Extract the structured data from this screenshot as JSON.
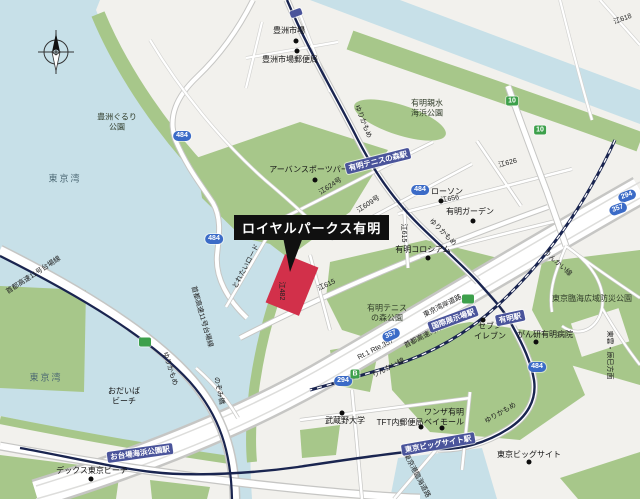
{
  "callout": {
    "text": "ロイヤルパークス有明"
  },
  "map": {
    "compass_icon": "north-compass",
    "colors": {
      "water": "#c7e0e8",
      "land": "#f2f1ed",
      "park": "#a7c78a",
      "rail": "#1a2550",
      "station_bg": "#4a549b",
      "shield_blue": "#3b6bc7",
      "shield_green": "#3da04b",
      "highlight_red": "#d2304a",
      "callout_bg": "#101010"
    },
    "water_labels": [
      {
        "text": "東京湾",
        "x": 65,
        "y": 179
      },
      {
        "text": "東京湾",
        "x": 46,
        "y": 378
      }
    ],
    "park_labels": [
      {
        "text": "豊洲ぐるり\n公園",
        "x": 117,
        "y": 122
      },
      {
        "text": "有明親水\n海浜公園",
        "x": 427,
        "y": 108
      },
      {
        "text": "有明テニス\nの森公園",
        "x": 387,
        "y": 313
      },
      {
        "text": "東京臨海広域防災公園",
        "x": 592,
        "y": 299
      }
    ],
    "pois": [
      {
        "text": "豊洲市場",
        "x": 289,
        "y": 31,
        "dot": [
          296,
          41
        ]
      },
      {
        "text": "豊洲市場郵便局",
        "x": 290,
        "y": 60,
        "dot": [
          297,
          51
        ]
      },
      {
        "text": "アーバンスポーツパーク",
        "x": 313,
        "y": 170,
        "dot": [
          315,
          180
        ]
      },
      {
        "text": "ローソン",
        "x": 447,
        "y": 192,
        "dot": [
          441,
          201
        ]
      },
      {
        "text": "有明ガーデン",
        "x": 470,
        "y": 212,
        "dot": [
          473,
          221
        ]
      },
      {
        "text": "有明コロシアム",
        "x": 423,
        "y": 250,
        "dot": [
          428,
          258
        ]
      },
      {
        "text": "セブン\nイレブン",
        "x": 490,
        "y": 331,
        "dot": [
          483,
          320
        ]
      },
      {
        "text": "がん研有明病院",
        "x": 545,
        "y": 335,
        "dot": [
          536,
          342
        ]
      },
      {
        "text": "武蔵野大学",
        "x": 345,
        "y": 421,
        "dot": [
          342,
          413
        ]
      },
      {
        "text": "TFT内郵便局",
        "x": 400,
        "y": 423,
        "dot": [
          421,
          427
        ]
      },
      {
        "text": "ワンザ有明\nベイモール",
        "x": 444,
        "y": 417,
        "dot": [
          442,
          428
        ]
      },
      {
        "text": "東京ビッグサイト",
        "x": 529,
        "y": 455,
        "dot": [
          529,
          462
        ]
      },
      {
        "text": "デックス東京ビーチ",
        "x": 92,
        "y": 471,
        "dot": [
          91,
          479
        ]
      },
      {
        "text": "おだいば\nビーチ",
        "x": 124,
        "y": 396
      }
    ],
    "stations": [
      {
        "text": "有明テニスの森駅",
        "x": 378,
        "y": 161,
        "rot": -14
      },
      {
        "text": "有明駅",
        "x": 510,
        "y": 318,
        "rot": -12
      },
      {
        "text": "国際展示場駅",
        "x": 453,
        "y": 319,
        "rot": -20
      },
      {
        "text": "東京ビッグサイト駅",
        "x": 438,
        "y": 444,
        "rot": -10
      },
      {
        "text": "お台場海浜公園駅",
        "x": 140,
        "y": 453,
        "rot": -8
      },
      {
        "text": "",
        "x": 296,
        "y": 13,
        "rot": -20
      }
    ],
    "route_shields_blue": [
      {
        "text": "484",
        "x": 182,
        "y": 136
      },
      {
        "text": "484",
        "x": 214,
        "y": 239
      },
      {
        "text": "484",
        "x": 420,
        "y": 190
      },
      {
        "text": "357",
        "x": 391,
        "y": 335,
        "rot": -25
      },
      {
        "text": "294",
        "x": 343,
        "y": 381
      },
      {
        "text": "484",
        "x": 537,
        "y": 367
      },
      {
        "text": "294",
        "x": 627,
        "y": 196,
        "rot": -20
      },
      {
        "text": "357",
        "x": 618,
        "y": 209,
        "rot": -20
      }
    ],
    "route_shields_green": [
      {
        "text": "10",
        "x": 512,
        "y": 101
      },
      {
        "text": "10",
        "x": 540,
        "y": 130
      },
      {
        "text": "B",
        "x": 355,
        "y": 374
      },
      {
        "text": "",
        "x": 468,
        "y": 299
      },
      {
        "text": "",
        "x": 145,
        "y": 342
      }
    ],
    "road_labels": [
      {
        "text": "江624号",
        "x": 331,
        "y": 187,
        "rot": -33
      },
      {
        "text": "江609号",
        "x": 369,
        "y": 205,
        "rot": -33
      },
      {
        "text": "江656",
        "x": 450,
        "y": 200,
        "rot": -10
      },
      {
        "text": "江615",
        "x": 403,
        "y": 233,
        "rot": 90
      },
      {
        "text": "江615",
        "x": 327,
        "y": 286,
        "rot": -25
      },
      {
        "text": "江482",
        "x": 281,
        "y": 291,
        "rot": 90
      },
      {
        "text": "江626",
        "x": 508,
        "y": 164,
        "rot": -15
      },
      {
        "text": "江618",
        "x": 623,
        "y": 20,
        "rot": -20
      }
    ],
    "line_labels": [
      {
        "text": "ゆりかもめ",
        "x": 362,
        "y": 122,
        "rot": 68
      },
      {
        "text": "ゆりかもめ",
        "x": 442,
        "y": 233,
        "rot": 45
      },
      {
        "text": "ゆりかもめ",
        "x": 169,
        "y": 369,
        "rot": 72
      },
      {
        "text": "ゆりかもめ",
        "x": 501,
        "y": 414,
        "rot": -30
      },
      {
        "text": "りんかい線",
        "x": 557,
        "y": 264,
        "rot": 42
      },
      {
        "text": "りんかい線",
        "x": 389,
        "y": 369,
        "rot": -27
      },
      {
        "text": "首都高速湾岸線",
        "x": 427,
        "y": 336,
        "rot": -27
      },
      {
        "text": "東京湾岸道路",
        "x": 443,
        "y": 307,
        "rot": -27
      },
      {
        "text": "Rt.1 Rte.357",
        "x": 376,
        "y": 350,
        "rot": -27
      },
      {
        "text": "首都高速11号台場線",
        "x": 34,
        "y": 276,
        "rot": -33
      },
      {
        "text": "首都高速11号台場線",
        "x": 201,
        "y": 317,
        "rot": 74
      },
      {
        "text": "東京港臨海道路",
        "x": 416,
        "y": 476,
        "rot": 62
      },
      {
        "text": "東雲・辰巳方面",
        "x": 609,
        "y": 355,
        "rot": 90
      },
      {
        "text": "とれたいロード",
        "x": 247,
        "y": 267,
        "rot": -62
      },
      {
        "text": "のぞみ橋",
        "x": 218,
        "y": 391,
        "rot": 78
      }
    ]
  }
}
